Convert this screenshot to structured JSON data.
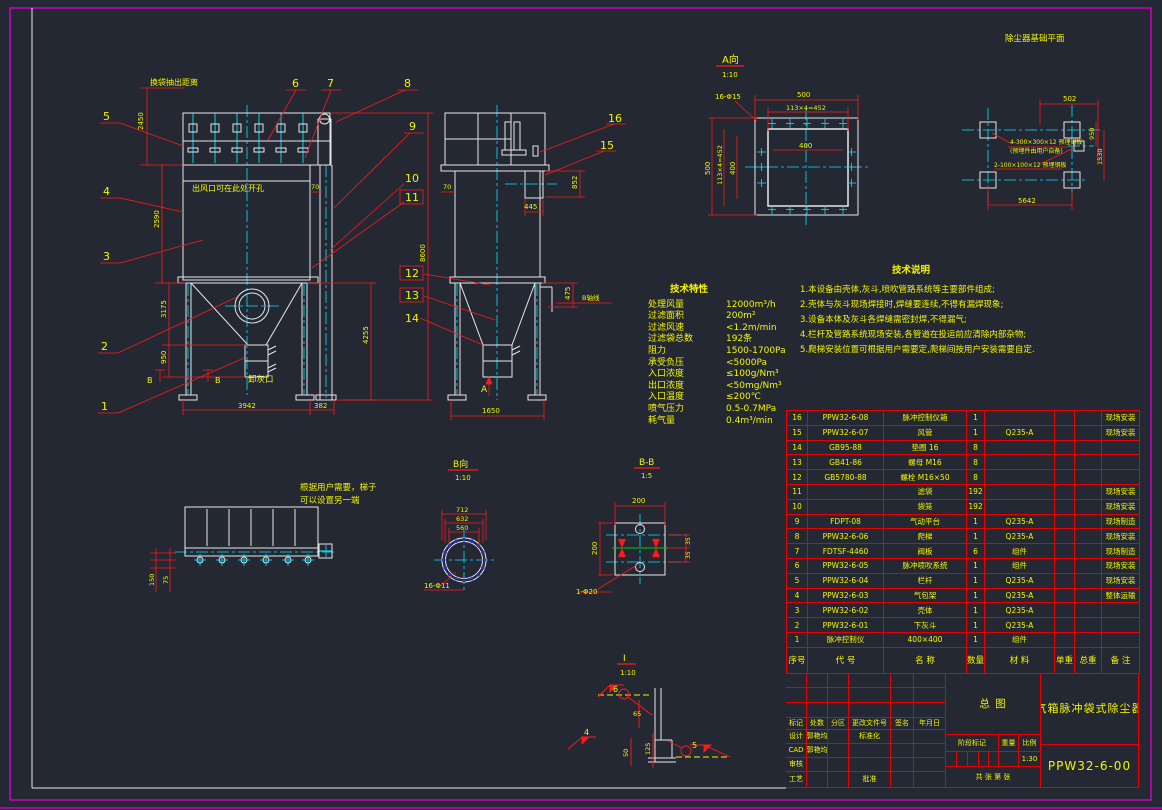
{
  "colors": {
    "background": "#232833",
    "geometry": "#e8e8e8",
    "centerline": "#00e5ff",
    "dimension": "#ff1a1a",
    "text": "#f5f500",
    "border": "#cc00cc",
    "hole_dot": "#2430c0",
    "gasket": "#00cc00"
  },
  "views": {
    "front": {
      "extract_note": "换袋抽出距离",
      "outlet_note": "出风口可在此处开孔",
      "ash_note": "卸灰口",
      "section_mark": "B",
      "dims": {
        "extract": "2450",
        "body": "2590",
        "hopper": "3175",
        "discharge": "950",
        "width": "3942",
        "duct": "382",
        "right1": "4255",
        "total": "8600",
        "gap": "70"
      }
    },
    "side": {
      "dims": {
        "gap": "70",
        "inlet_h": "852",
        "inlet_w": "445",
        "axis": "475",
        "width": "1650"
      },
      "axis_note": "B轴线",
      "view_mark": "A"
    },
    "plan": {
      "note1": "根据用户需要，梯子",
      "note2": "可以设置另一端",
      "dims": {
        "d1": "150",
        "d2": "75"
      }
    },
    "detail_a": {
      "title": "A向",
      "scale": "1:10",
      "holes": "16-Φ15",
      "dims": {
        "w": "500",
        "wsub": "113×4=452",
        "win": "400",
        "h": "500",
        "hsub": "113×4=452",
        "hin": "400"
      }
    },
    "foundation": {
      "title": "除尘器基础平面",
      "note1": "4-300×300×12 预埋钢板",
      "note2": "(预埋件由用户自备)",
      "note3": "2-100×100×12 预埋钢板",
      "dims": {
        "d502": "502",
        "d950": "950",
        "d1530": "1530",
        "d5642": "5642"
      }
    },
    "flange": {
      "title": "B向",
      "scale": "1:10",
      "holes": "16-Φ11",
      "dims": {
        "d712": "712",
        "d632": "632",
        "d560": "560"
      }
    },
    "plate": {
      "title": "B-B",
      "scale": "1:5",
      "hole": "1-Φ20",
      "dims": {
        "w": "200",
        "h": "200",
        "s1": "35",
        "s2": "35"
      }
    },
    "weld": {
      "title": "I",
      "scale": "1:10",
      "marks": {
        "m6": "6",
        "m4": "4",
        "m5": "5"
      },
      "dims": {
        "d65": "65",
        "d50": "50",
        "d125": "125"
      }
    }
  },
  "balloons": {
    "1": "1",
    "2": "2",
    "3": "3",
    "4": "4",
    "5": "5",
    "6": "6",
    "7": "7",
    "8": "8",
    "9": "9",
    "10": "10",
    "11": "11",
    "12": "12",
    "13": "13",
    "14": "14",
    "15": "15",
    "16": "16"
  },
  "tech_specs": {
    "title": "技术特性",
    "rows": [
      {
        "label": "处理风量",
        "value": "12000m³/h"
      },
      {
        "label": "过滤面积",
        "value": "200m²"
      },
      {
        "label": "过滤风速",
        "value": "<1.2m/min"
      },
      {
        "label": "过滤袋总数",
        "value": "192条"
      },
      {
        "label": "阻力",
        "value": "1500-1700Pa"
      },
      {
        "label": "承受负压",
        "value": "<5000Pa"
      },
      {
        "label": "入口浓度",
        "value": "≤100g/Nm³"
      },
      {
        "label": "出口浓度",
        "value": "<50mg/Nm³"
      },
      {
        "label": "入口温度",
        "value": "≤200℃"
      },
      {
        "label": "喷气压力",
        "value": "0.5-0.7MPa"
      },
      {
        "label": "耗气量",
        "value": "0.4m³/min"
      }
    ]
  },
  "tech_notes": {
    "title": "技术说明",
    "items": [
      "1.本设备由壳体,灰斗,喷吹管路系统等主要部件组成;",
      "2.壳体与灰斗现场焊接时,焊缝要连续,不得有漏焊现象;",
      "3.设备本体及灰斗各焊缝需密封焊,不得漏气;",
      "4.栏杆及管路系统现场安装,各管道在投运前应清除内部杂物;",
      "5.爬梯安装位置可根据用户需要定,爬梯间按用户安装需要自定."
    ]
  },
  "bom": {
    "headers": [
      "序号",
      "代  号",
      "名  称",
      "数量",
      "材  料",
      "单重",
      "总重",
      "备 注"
    ],
    "rows": [
      [
        "16",
        "PPW32-6-08",
        "脉冲控制仪箱",
        "1",
        "",
        "",
        "",
        "现场安装"
      ],
      [
        "15",
        "PPW32-6-07",
        "风管",
        "1",
        "Q235-A",
        "",
        "",
        "现场安装"
      ],
      [
        "14",
        "GB95-88",
        "垫圈 16",
        "8",
        "",
        "",
        "",
        ""
      ],
      [
        "13",
        "GB41-86",
        "螺母 M16",
        "8",
        "",
        "",
        "",
        ""
      ],
      [
        "12",
        "GB5780-88",
        "螺栓 M16×50",
        "8",
        "",
        "",
        "",
        ""
      ],
      [
        "11",
        "",
        "滤袋",
        "192",
        "",
        "",
        "",
        "现场安装"
      ],
      [
        "10",
        "",
        "袋笼",
        "192",
        "",
        "",
        "",
        "现场安装"
      ],
      [
        "9",
        "FDPT-08",
        "气动平台",
        "1",
        "Q235-A",
        "",
        "",
        "现场制造"
      ],
      [
        "8",
        "PPW32-6-06",
        "爬梯",
        "1",
        "Q235-A",
        "",
        "",
        "现场安装"
      ],
      [
        "7",
        "FDTSF-4460",
        "阀板",
        "6",
        "组件",
        "",
        "",
        "现场制造"
      ],
      [
        "6",
        "PPW32-6-05",
        "脉冲喷吹系统",
        "1",
        "组件",
        "",
        "",
        "现场安装"
      ],
      [
        "5",
        "PPW32-6-04",
        "栏杆",
        "1",
        "Q235-A",
        "",
        "",
        "现场安装"
      ],
      [
        "4",
        "PPW32-6-03",
        "气包架",
        "1",
        "Q235-A",
        "",
        "",
        "整体运输"
      ],
      [
        "3",
        "PPW32-6-02",
        "壳体",
        "1",
        "Q235-A",
        "",
        "",
        ""
      ],
      [
        "2",
        "PPW32-6-01",
        "下灰斗",
        "1",
        "Q235-A",
        "",
        "",
        ""
      ],
      [
        "1",
        "脉冲控制仪",
        "400×400",
        "1",
        "组件",
        "",
        "",
        ""
      ]
    ]
  },
  "title_block": {
    "rev_headers": [
      "标记",
      "处数",
      "分区",
      "更改文件号",
      "签名",
      "年月日"
    ],
    "rows": [
      {
        "role": "设计",
        "name": "郭艳均",
        "extra": "标准化"
      },
      {
        "role": "CAD",
        "name": "郭艳均",
        "extra": ""
      },
      {
        "role": "审核",
        "name": "",
        "extra": ""
      },
      {
        "role": "工艺",
        "name": "",
        "extra": "批准"
      }
    ],
    "general": "总  图",
    "stage_label": "阶段标记",
    "weight_label": "重量",
    "scale_label": "比例",
    "scale_value": "1:30",
    "sheet_note": "共  张 第  张",
    "product_title": "气箱脉冲袋式除尘器",
    "drawing_no": "PPW32-6-00"
  }
}
